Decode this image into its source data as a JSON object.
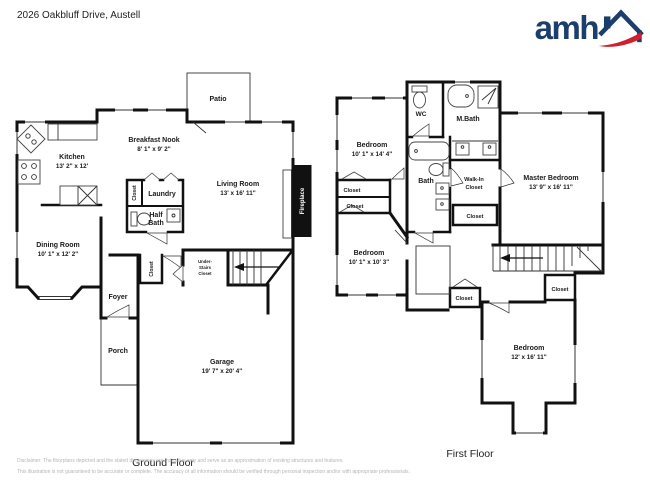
{
  "header": {
    "address": "2026 Oakbluff Drive, Austell",
    "logo_text": "amh"
  },
  "colors": {
    "logo_blue": "#1b3e6d",
    "logo_red": "#cf2030",
    "wall_black": "#111111",
    "disclaimer_gray": "#b5b5b5"
  },
  "ground_floor": {
    "floor_label": "Ground Floor",
    "rooms": {
      "patio": {
        "name": "Patio"
      },
      "breakfast_nook": {
        "name": "Breakfast Nook",
        "dims": "8' 1\" x 9' 2\""
      },
      "kitchen": {
        "name": "Kitchen",
        "dims": "13' 2\" x 12'"
      },
      "living_room": {
        "name": "Living Room",
        "dims": "13' x 16' 11\""
      },
      "dining_room": {
        "name": "Dining Room",
        "dims": "10' 1\" x 12' 2\""
      },
      "laundry": {
        "name": "Laundry"
      },
      "laundry_closet": {
        "name": "Closet"
      },
      "half_bath": {
        "line1": "Half",
        "line2": "Bath"
      },
      "fireplace": {
        "name": "Fireplace"
      },
      "under_stairs_closet": {
        "line1": "Under-",
        "line2": "Stairs",
        "line3": "Closet"
      },
      "foyer": {
        "name": "Foyer"
      },
      "foyer_closet": {
        "name": "Closet"
      },
      "porch": {
        "name": "Porch"
      },
      "garage": {
        "name": "Garage",
        "dims": "19' 7\" x 20' 4\""
      }
    }
  },
  "first_floor": {
    "floor_label": "First Floor",
    "rooms": {
      "bedroom_top": {
        "name": "Bedroom",
        "dims": "10' 1\" x 14' 4\""
      },
      "wc": {
        "name": "WC"
      },
      "m_bath": {
        "name": "M.Bath"
      },
      "master_bedroom": {
        "name": "Master Bedroom",
        "dims": "13' 9\" x 16' 11\""
      },
      "bath": {
        "name": "Bath"
      },
      "walk_in_closet": {
        "line1": "Walk-In",
        "line2": "Closet"
      },
      "closet_below_walkin": {
        "name": "Closet"
      },
      "closet_left_upper": {
        "name": "Closet"
      },
      "closet_left_lower": {
        "name": "Closet"
      },
      "bedroom_mid": {
        "name": "Bedroom",
        "dims": "10' 1\" x 10' 3\""
      },
      "closet_hall": {
        "name": "Closet"
      },
      "closet_stairs": {
        "name": "Closet"
      },
      "bedroom_bottom": {
        "name": "Bedroom",
        "dims": "12' x 16' 11\""
      }
    }
  },
  "disclaimer": {
    "line1": "Disclaimer: The floorplans depicted and the stated dimensions are indicative only and serve as an approximation of existing structures and features.",
    "line2": "This illustration is not guaranteed to be accurate or complete. The accuracy of all information should be verified through personal inspection and/or with appropriate professionals."
  }
}
